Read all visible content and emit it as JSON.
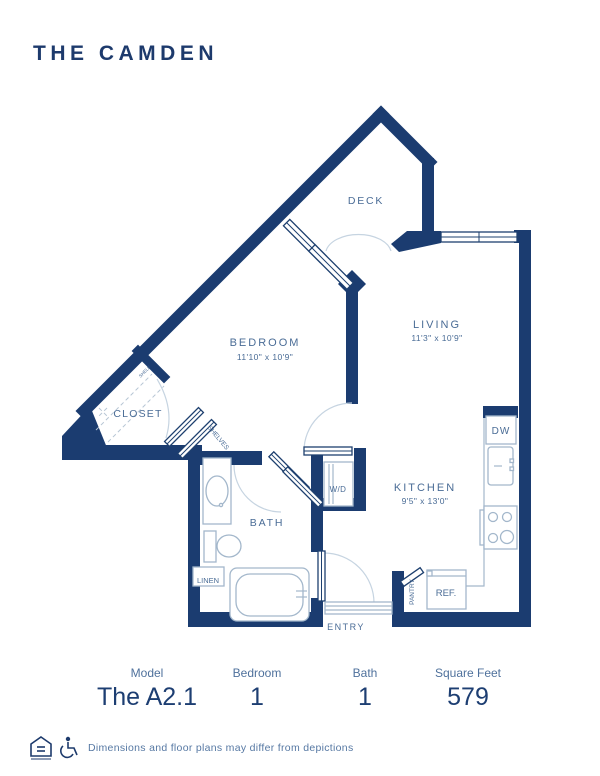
{
  "header": {
    "title": "THE CAMDEN"
  },
  "plan": {
    "deck_label": "DECK",
    "living_label": "LIVING",
    "living_dims": "11'3\" x 10'9\"",
    "bedroom_label": "BEDROOM",
    "bedroom_dims": "11'10\" x 10'9\"",
    "kitchen_label": "KITCHEN",
    "kitchen_dims": "9'5\" x 13'0\"",
    "bath_label": "BATH",
    "closet_label": "CLOSET",
    "shelves_label": "SHELVES",
    "shelf_label": "SHELF",
    "wd_label": "W/D",
    "dw_label": "DW",
    "ref_label": "REF.",
    "linen_label": "LINEN",
    "pantry_label": "PANTRY",
    "entry_label": "ENTRY"
  },
  "stats": [
    {
      "label": "Model",
      "value": "The A2.1"
    },
    {
      "label": "Bedroom",
      "value": "1"
    },
    {
      "label": "Bath",
      "value": "1"
    },
    {
      "label": "Square Feet",
      "value": "579"
    }
  ],
  "footer": {
    "disclaimer": "Dimensions and floor plans may differ from depictions"
  },
  "colors": {
    "wall": "#1b3c70",
    "label": "#4a6c96",
    "value": "#1d3e72"
  }
}
